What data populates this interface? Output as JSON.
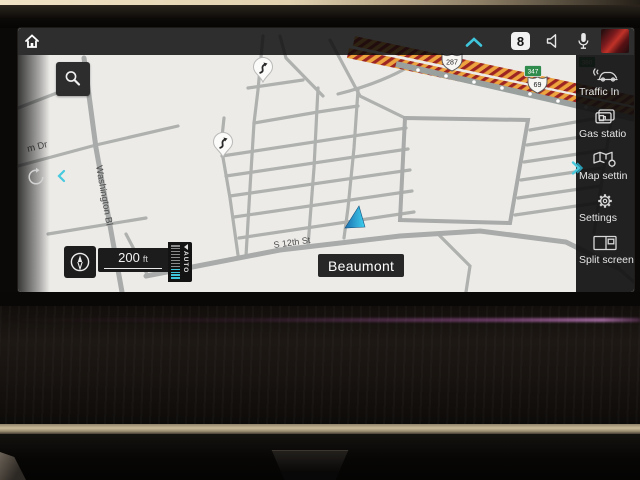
{
  "status_bar": {
    "badge_count": "8",
    "icons": [
      "home-icon",
      "chevron-up-icon",
      "notification-count-badge",
      "speaker-icon",
      "microphone-icon",
      "media-thumbnail"
    ]
  },
  "sidebar": {
    "collapse_icon": "chevron-right-icon",
    "items": [
      {
        "icon": "traffic-info-icon",
        "label": "Traffic In"
      },
      {
        "icon": "gas-stations-icon",
        "label": "Gas statio"
      },
      {
        "icon": "map-settings-icon",
        "label": "Map settin"
      },
      {
        "icon": "gear-icon",
        "label": "Settings"
      },
      {
        "icon": "split-screen-icon",
        "label": "Split screen"
      }
    ]
  },
  "map": {
    "city_label": "Beaumont",
    "streets": [
      {
        "text": "m Dr"
      },
      {
        "text": "Washington Bl"
      },
      {
        "text": "S 12th St"
      }
    ],
    "shields": [
      {
        "type": "us-route",
        "label": "287"
      },
      {
        "type": "us-route",
        "label": "69"
      },
      {
        "type": "green-route",
        "label": "347"
      },
      {
        "type": "green-route",
        "label": "380"
      }
    ],
    "poi_pins": [
      {
        "icon": "winding-road-pin"
      },
      {
        "icon": "winding-road-pin"
      }
    ],
    "vehicle_marker": {
      "type": "position-arrow",
      "color": "#35b9e6"
    },
    "scale_value": "200",
    "scale_unit": "ft",
    "zoom_mode": "AUTO"
  },
  "controls": {
    "search_icon": "magnifier-icon",
    "compass_icon": "compass-icon",
    "back_icon": "circular-arrow-icon",
    "collapse_left_icon": "chevron-left-icon"
  },
  "colors": {
    "accent_cyan": "#3fc6dc",
    "map_bg": "#ecebe8",
    "road": "#aeb1ae",
    "highway": "#eda33e",
    "highway_stripe": "#9c2422",
    "panel": "#141414"
  }
}
